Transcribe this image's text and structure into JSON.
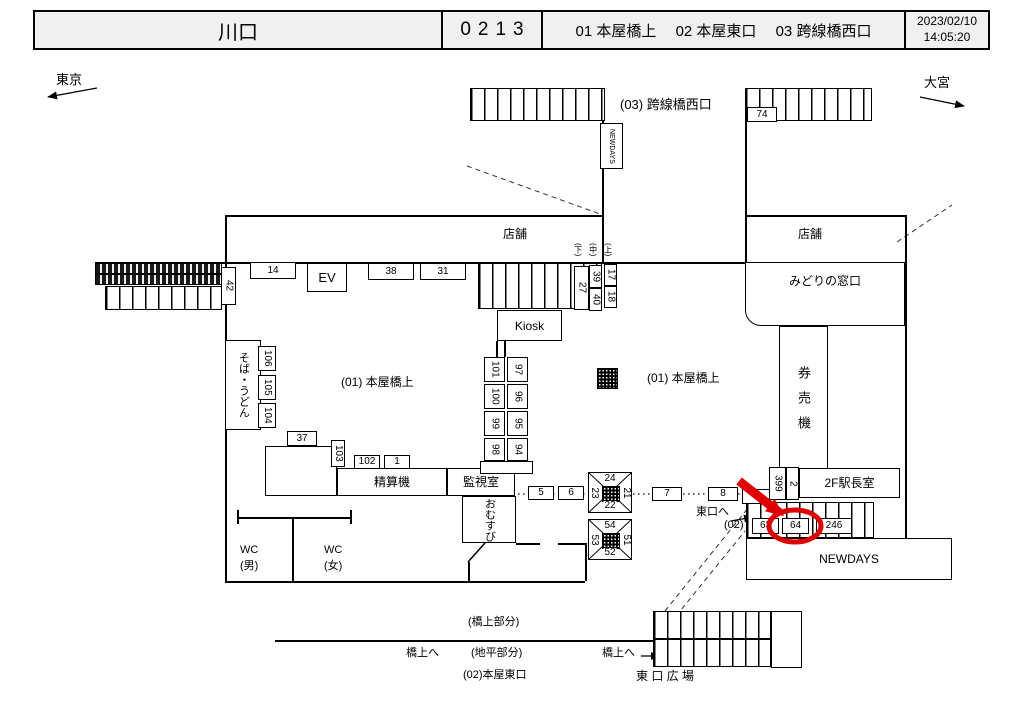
{
  "header": {
    "station_name": "川口",
    "station_code": "0213",
    "areas": [
      {
        "no": "01",
        "name": "本屋橋上"
      },
      {
        "no": "02",
        "name": "本屋東口"
      },
      {
        "no": "03",
        "name": "跨線橋西口"
      }
    ],
    "date": "2023/02/10",
    "time": "14:05:20"
  },
  "map": {
    "direction_left": "東京",
    "direction_right": "大宮",
    "accent_color": "#dd0000",
    "selected_camera": "64",
    "labels": [
      {
        "name": "bridge-west-exit-label",
        "text": "(03) 跨線橋西口",
        "x": 620,
        "y": 96,
        "fs": 13
      },
      {
        "name": "store-label-left",
        "text": "店舗",
        "x": 503,
        "y": 226,
        "fs": 12
      },
      {
        "name": "store-label-right",
        "text": "798店舗",
        "x": 798,
        "y": 226,
        "fs": 12,
        "textfix": "店舗"
      },
      {
        "name": "honya-bridge-label-left",
        "text": "(01) 本屋橋上",
        "x": 341,
        "y": 374,
        "fs": 12
      },
      {
        "name": "honya-bridge-label-right",
        "text": "(01) 本屋橋上",
        "x": 647,
        "y": 370,
        "fs": 12
      },
      {
        "name": "stair-label-down",
        "text": "(下)",
        "x": 572,
        "y": 243,
        "fs": 8,
        "v": true
      },
      {
        "name": "stair-label-middle",
        "text": "(中)",
        "x": 587,
        "y": 243,
        "fs": 8,
        "v": true
      },
      {
        "name": "stair-label-up",
        "text": "(上)",
        "x": 602,
        "y": 243,
        "fs": 8,
        "v": true
      },
      {
        "name": "wc-men-label",
        "text": "WC\n(男)",
        "x": 240,
        "y": 543,
        "fs": 11
      },
      {
        "name": "wc-women-label",
        "text": "WC\n(女)",
        "x": 324,
        "y": 543,
        "fs": 11
      },
      {
        "name": "to-east-exit-label",
        "text": "東口へ",
        "x": 696,
        "y": 505,
        "fs": 11
      },
      {
        "name": "area02-marker-label",
        "text": "(02)",
        "x": 724,
        "y": 518,
        "fs": 11
      },
      {
        "name": "bridge-part-label",
        "text": "(橋上部分)",
        "x": 468,
        "y": 615,
        "fs": 11
      },
      {
        "name": "to-bridge-label-left",
        "text": "橋上へ",
        "x": 406,
        "y": 646,
        "fs": 11
      },
      {
        "name": "ground-part-label",
        "text": "(地平部分)",
        "x": 471,
        "y": 646,
        "fs": 11
      },
      {
        "name": "honya-east-exit-label",
        "text": "(02)本屋東口",
        "x": 463,
        "y": 668,
        "fs": 11
      },
      {
        "name": "to-bridge-label-right",
        "text": "橋上へ",
        "x": 602,
        "y": 646,
        "fs": 11
      },
      {
        "name": "east-exit-plaza-label",
        "text": "東 口 広 場",
        "x": 636,
        "y": 668,
        "fs": 12
      },
      {
        "name": "direction-tokyo",
        "text": "東京",
        "x": 56,
        "y": 71,
        "fs": 13
      },
      {
        "name": "direction-omiya",
        "text": "大宮",
        "x": 924,
        "y": 74,
        "fs": 13
      }
    ],
    "rooms": [
      {
        "name": "ev",
        "label": "EV",
        "x": 307,
        "y": 263,
        "w": 40,
        "h": 29,
        "fs": 13
      },
      {
        "name": "kiosk",
        "label": "Kiosk",
        "x": 497,
        "y": 310,
        "w": 65,
        "h": 31,
        "fs": 12
      },
      {
        "name": "fare-adjustment",
        "label": "精算機",
        "x": 337,
        "y": 468,
        "w": 110,
        "h": 28,
        "fs": 12
      },
      {
        "name": "monitor-room",
        "label": "監視室",
        "x": 447,
        "y": 468,
        "w": 68,
        "h": 28,
        "fs": 12
      },
      {
        "name": "omusubi",
        "label": "おむすび",
        "x": 462,
        "y": 496,
        "w": 54,
        "h": 47,
        "fs": 11,
        "vert": true
      },
      {
        "name": "soba-udon",
        "label": "そば・うどん",
        "x": 225,
        "y": 340,
        "w": 36,
        "h": 90,
        "fs": 11,
        "vert": true
      },
      {
        "name": "midori-no-madoguchi",
        "label": "みどりの窓口",
        "x": 745,
        "y": 262,
        "w": 160,
        "h": 64,
        "fs": 12,
        "cls": "rbl ltop"
      },
      {
        "name": "ticket-vending-machines",
        "label": "券売機",
        "x": 779,
        "y": 326,
        "w": 49,
        "h": 144,
        "fs": 13,
        "vert": true,
        "cls": "spread"
      },
      {
        "name": "stationmaster-office-2f",
        "label": "2F駅長室",
        "x": 799,
        "y": 468,
        "w": 101,
        "h": 30,
        "fs": 12
      },
      {
        "name": "newdays-store",
        "label": "NEWDAYS",
        "x": 746,
        "y": 538,
        "w": 206,
        "h": 42,
        "fs": 12
      },
      {
        "name": "newdays-bridge-kiosk",
        "label": "NEWDAYS",
        "x": 600,
        "y": 123,
        "w": 23,
        "h": 46,
        "fs": 7,
        "vert": true
      },
      {
        "name": "store-annex",
        "label": "",
        "x": 265,
        "y": 446,
        "w": 72,
        "h": 50
      },
      {
        "name": "column-base",
        "label": "",
        "x": 480,
        "y": 461,
        "w": 53,
        "h": 13
      },
      {
        "name": "lower-stairs-side",
        "label": "",
        "x": 771,
        "y": 611,
        "w": 31,
        "h": 57
      }
    ],
    "camera_boxes": [
      {
        "id": "74",
        "x": 747,
        "y": 107,
        "w": 30,
        "h": 15
      },
      {
        "id": "42",
        "x": 221,
        "y": 267,
        "w": 15,
        "h": 38,
        "v": true
      },
      {
        "id": "14",
        "x": 250,
        "y": 262,
        "w": 46,
        "h": 17
      },
      {
        "id": "38",
        "x": 368,
        "y": 263,
        "w": 46,
        "h": 17
      },
      {
        "id": "31",
        "x": 420,
        "y": 263,
        "w": 46,
        "h": 17
      },
      {
        "id": "27",
        "x": 574,
        "y": 266,
        "w": 15,
        "h": 44,
        "v": true
      },
      {
        "id": "39",
        "x": 589,
        "y": 265,
        "w": 13,
        "h": 23,
        "v": true
      },
      {
        "id": "40",
        "x": 589,
        "y": 288,
        "w": 13,
        "h": 23,
        "v": true
      },
      {
        "id": "17",
        "x": 604,
        "y": 264,
        "w": 13,
        "h": 22,
        "v": true
      },
      {
        "id": "18",
        "x": 604,
        "y": 286,
        "w": 13,
        "h": 22,
        "v": true
      },
      {
        "id": "106",
        "x": 258,
        "y": 346,
        "w": 18,
        "h": 25,
        "v": true
      },
      {
        "id": "105",
        "x": 258,
        "y": 375,
        "w": 18,
        "h": 25,
        "v": true
      },
      {
        "id": "104",
        "x": 258,
        "y": 403,
        "w": 18,
        "h": 25,
        "v": true
      },
      {
        "id": "101",
        "x": 484,
        "y": 357,
        "w": 21,
        "h": 25,
        "v": true
      },
      {
        "id": "97",
        "x": 507,
        "y": 357,
        "w": 21,
        "h": 25,
        "v": true
      },
      {
        "id": "100",
        "x": 484,
        "y": 384,
        "w": 21,
        "h": 25,
        "v": true
      },
      {
        "id": "96",
        "x": 507,
        "y": 384,
        "w": 21,
        "h": 25,
        "v": true
      },
      {
        "id": "99",
        "x": 484,
        "y": 411,
        "w": 21,
        "h": 25,
        "v": true
      },
      {
        "id": "95",
        "x": 507,
        "y": 411,
        "w": 21,
        "h": 25,
        "v": true
      },
      {
        "id": "98",
        "x": 484,
        "y": 438,
        "w": 21,
        "h": 23,
        "v": true
      },
      {
        "id": "94",
        "x": 507,
        "y": 438,
        "w": 21,
        "h": 23,
        "v": true
      },
      {
        "id": "37",
        "x": 287,
        "y": 431,
        "w": 30,
        "h": 15
      },
      {
        "id": "103",
        "x": 331,
        "y": 440,
        "w": 14,
        "h": 27,
        "v": true
      },
      {
        "id": "102",
        "x": 354,
        "y": 455,
        "w": 26,
        "h": 14
      },
      {
        "id": "1",
        "x": 384,
        "y": 455,
        "w": 26,
        "h": 14
      },
      {
        "id": "5",
        "x": 528,
        "y": 486,
        "w": 26,
        "h": 14
      },
      {
        "id": "6",
        "x": 558,
        "y": 486,
        "w": 26,
        "h": 14
      },
      {
        "id": "7",
        "x": 652,
        "y": 487,
        "w": 30,
        "h": 14
      },
      {
        "id": "8",
        "x": 708,
        "y": 487,
        "w": 30,
        "h": 14
      },
      {
        "id": "",
        "x": 742,
        "y": 489,
        "w": 28,
        "h": 15
      },
      {
        "id": "399",
        "x": 769,
        "y": 467,
        "w": 17,
        "h": 33,
        "v": true
      },
      {
        "id": "2",
        "x": 786,
        "y": 467,
        "w": 13,
        "h": 33,
        "v": true
      },
      {
        "id": "63",
        "x": 752,
        "y": 518,
        "w": 27,
        "h": 16
      },
      {
        "id": "64",
        "x": 782,
        "y": 518,
        "w": 27,
        "h": 16
      },
      {
        "id": "246",
        "x": 816,
        "y": 518,
        "w": 36,
        "h": 16
      }
    ],
    "xboxes": [
      {
        "name": "camera-cluster-20s",
        "x": 588,
        "y": 472,
        "w": 44,
        "h": 41,
        "top": "24",
        "right": "21",
        "bottom": "22",
        "left": "23"
      },
      {
        "name": "camera-cluster-50s",
        "x": 588,
        "y": 519,
        "w": 44,
        "h": 41,
        "top": "54",
        "right": "51",
        "bottom": "52",
        "left": "53"
      }
    ],
    "stairs": [
      {
        "name": "bridge-stairs-left",
        "x": 470,
        "y": 88,
        "w": 135,
        "h": 33
      },
      {
        "name": "bridge-stairs-right",
        "x": 745,
        "y": 88,
        "w": 127,
        "h": 33
      },
      {
        "name": "central-stairs",
        "x": 478,
        "y": 263,
        "w": 124,
        "h": 46
      },
      {
        "name": "east-stairs-upper",
        "x": 746,
        "y": 502,
        "w": 128,
        "h": 36
      },
      {
        "name": "east-stairs-lower-a",
        "x": 653,
        "y": 611,
        "w": 118,
        "h": 28
      },
      {
        "name": "east-stairs-lower-b",
        "x": 653,
        "y": 639,
        "w": 118,
        "h": 28
      },
      {
        "name": "platform-stairs-left",
        "x": 105,
        "y": 286,
        "w": 117,
        "h": 24
      }
    ],
    "escalator_bands": [
      {
        "x": 95,
        "y": 263,
        "w": 127,
        "h": 11
      },
      {
        "x": 95,
        "y": 274,
        "w": 127,
        "h": 11
      }
    ],
    "hatch_squares": [
      {
        "name": "pillar-hatch",
        "x": 597,
        "y": 368,
        "w": 21,
        "h": 21
      }
    ]
  }
}
